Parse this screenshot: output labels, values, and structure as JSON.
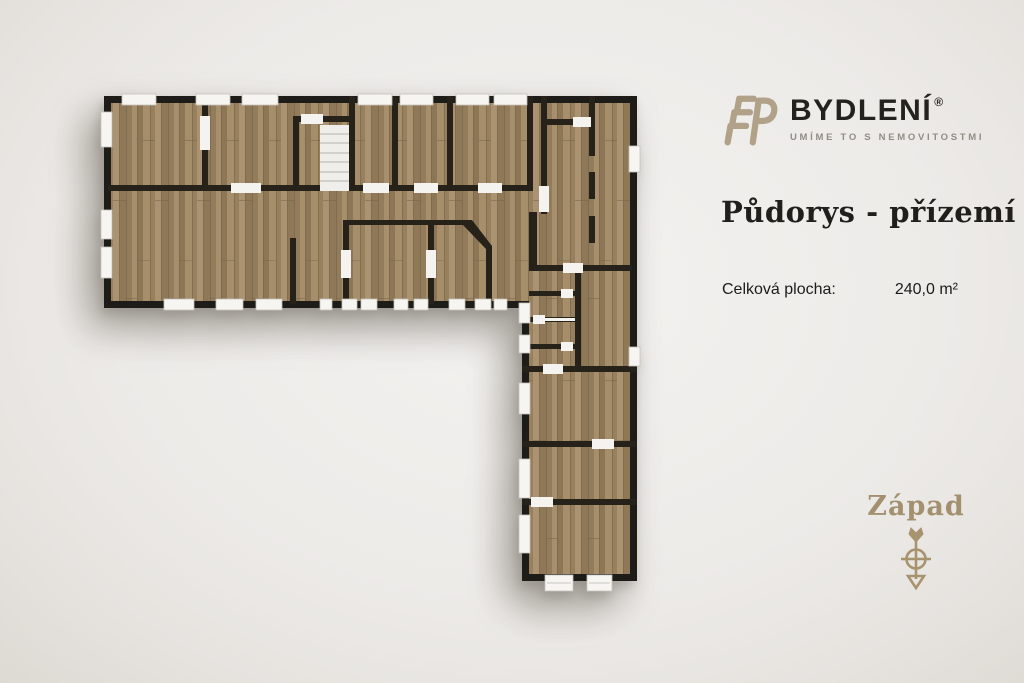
{
  "brand": {
    "name": "BYDLENÍ",
    "registered": "®",
    "tagline": "UMÍME TO S NEMOVITOSTMI",
    "monogram": "EP"
  },
  "heading": {
    "title": "Půdorys - přízemí"
  },
  "info": {
    "area_label": "Celková plocha:",
    "area_value": "240,0 m²"
  },
  "compass": {
    "direction_label": "Západ"
  },
  "icons": {
    "logo": "ep-monogram-icon",
    "compass": "compass-west-arrow-icon"
  },
  "colors": {
    "accent_tan": "#b2a189",
    "gold_text": "#a3906f",
    "text_dark": "#23221f",
    "text_gray": "#918d85",
    "wall": "#211e19",
    "wood_mid": "#a18a67",
    "window_white": "#f6f5f2",
    "background": "#edebe8"
  }
}
